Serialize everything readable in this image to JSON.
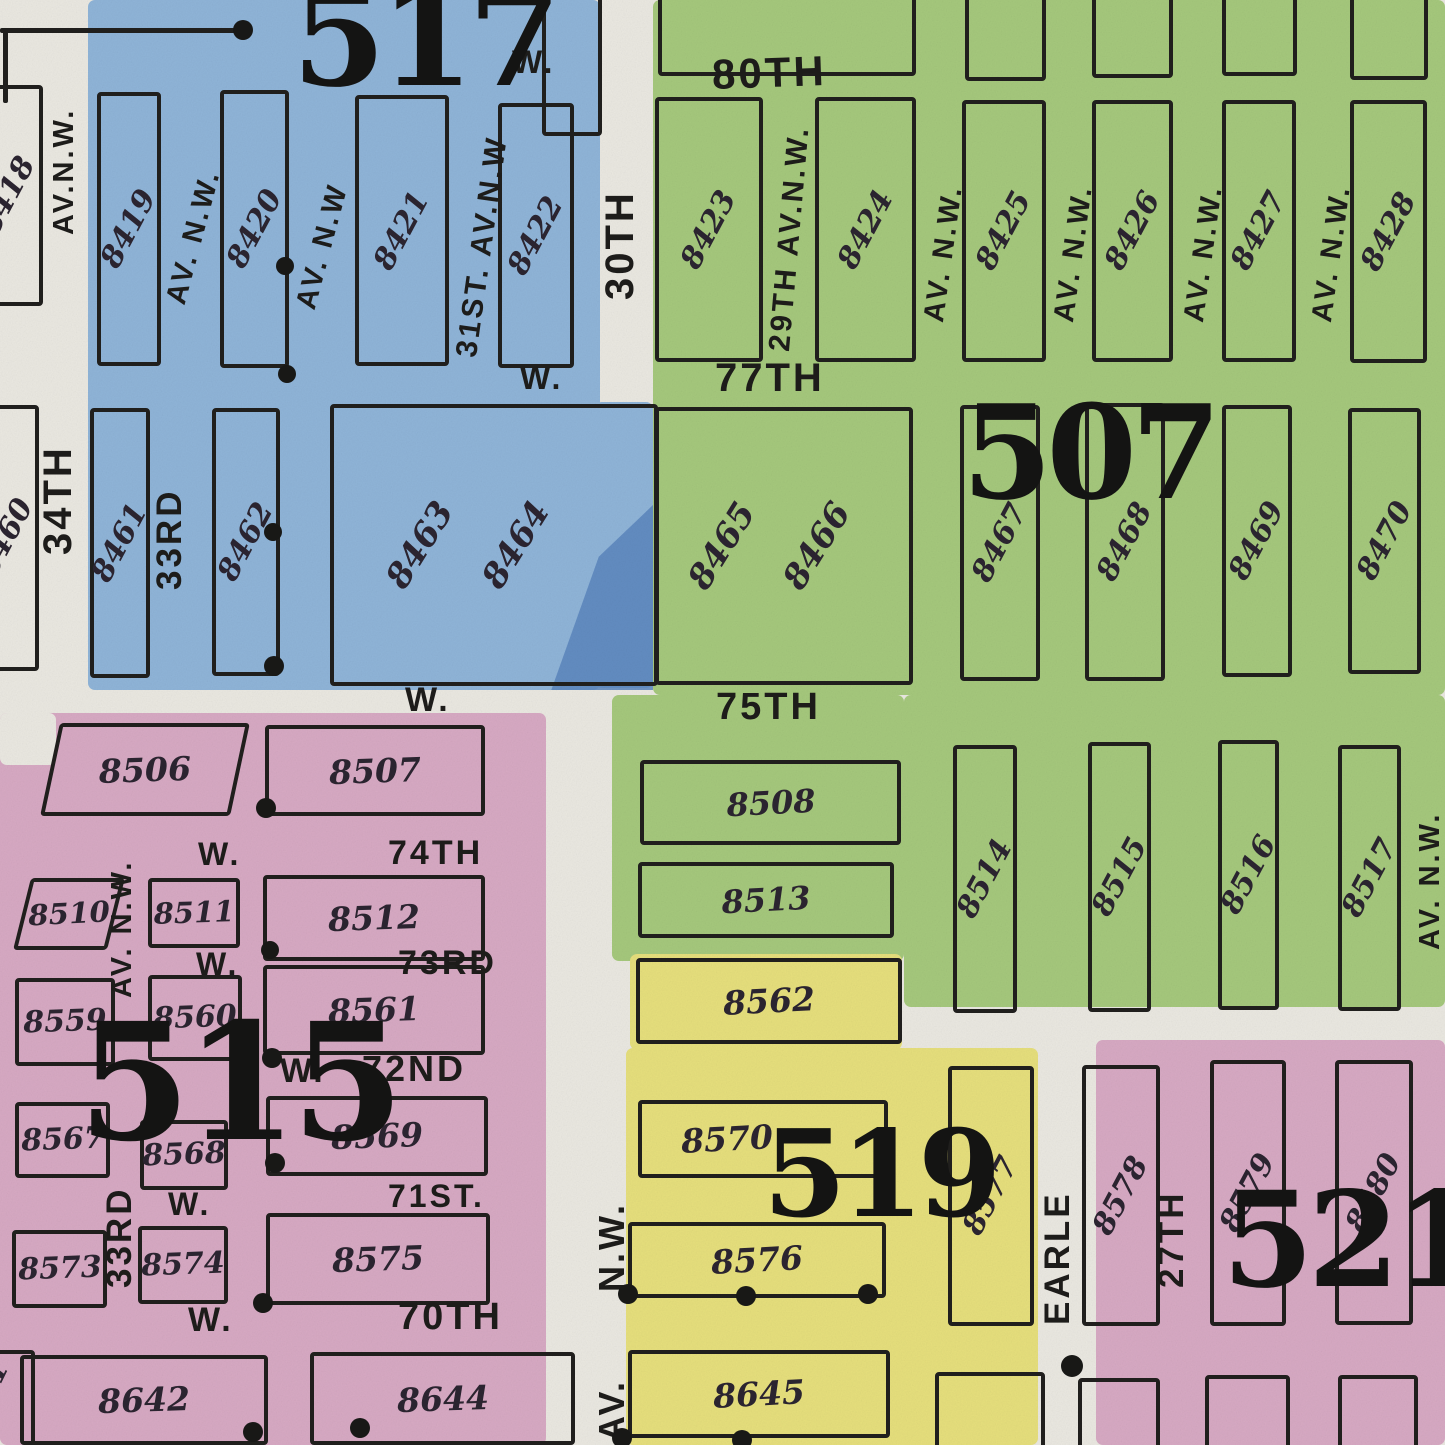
{
  "map_title": "Plat map sheet with insurance districts 507, 515, 517, 519, 521",
  "colors": {
    "paper": "#eae8e1",
    "ink": "#201f1d",
    "blue": "#8fb4d8",
    "blue_dark_streak": "#5a85bd",
    "green": "#a5c87c",
    "pink": "#d7a9c3",
    "yellow": "#e6df7c",
    "number_ink": "#2b2430"
  },
  "districts": [
    {
      "number": "517",
      "color": "blue"
    },
    {
      "number": "507",
      "color": "green"
    },
    {
      "number": "515",
      "color": "pink"
    },
    {
      "number": "519",
      "color": "yellow"
    },
    {
      "number": "521",
      "color": "pink"
    }
  ],
  "washes": [
    {
      "c": "blue",
      "x": 88,
      "y": 0,
      "w": 512,
      "h": 690
    },
    {
      "c": "blue",
      "x": 595,
      "y": 402,
      "w": 58,
      "h": 286
    },
    {
      "c": "green",
      "x": 653,
      "y": 0,
      "w": 792,
      "h": 695
    },
    {
      "c": "green",
      "x": 612,
      "y": 695,
      "w": 292,
      "h": 266
    },
    {
      "c": "green",
      "x": 904,
      "y": 695,
      "w": 541,
      "h": 312
    },
    {
      "c": "pink",
      "x": 0,
      "y": 713,
      "w": 546,
      "h": 732
    },
    {
      "c": "paper",
      "x": 0,
      "y": 713,
      "w": 56,
      "h": 52
    },
    {
      "c": "yellow",
      "x": 630,
      "y": 954,
      "w": 272,
      "h": 96
    },
    {
      "c": "yellow",
      "x": 626,
      "y": 1048,
      "w": 412,
      "h": 397
    },
    {
      "c": "pink",
      "x": 1096,
      "y": 1040,
      "w": 349,
      "h": 405
    }
  ],
  "streak": {
    "x": 540,
    "y": 505,
    "w": 113,
    "h": 185
  },
  "blocks": [
    {
      "n": "8418",
      "x": -28,
      "y": 85,
      "w": 63,
      "h": 213,
      "rot": -62,
      "fs": 30
    },
    {
      "n": "8419",
      "x": 97,
      "y": 92,
      "w": 56,
      "h": 266,
      "rot": -62,
      "fs": 30
    },
    {
      "n": "8420",
      "x": 220,
      "y": 90,
      "w": 61,
      "h": 270,
      "rot": -62,
      "fs": 30
    },
    {
      "n": "8421",
      "x": 355,
      "y": 95,
      "w": 86,
      "h": 263,
      "rot": -62,
      "fs": 30
    },
    {
      "n": "8422",
      "x": 498,
      "y": 103,
      "w": 68,
      "h": 257,
      "rot": -62,
      "fs": 30
    },
    {
      "n": "8460",
      "x": -28,
      "y": 405,
      "w": 59,
      "h": 258,
      "rot": -62,
      "fs": 30
    },
    {
      "n": "8461",
      "x": 90,
      "y": 408,
      "w": 52,
      "h": 262,
      "rot": -62,
      "fs": 30
    },
    {
      "n": "8462",
      "x": 212,
      "y": 408,
      "w": 60,
      "h": 260,
      "rot": -62,
      "fs": 30
    },
    {
      "nums": [
        {
          "t": "8463",
          "lx": 27
        },
        {
          "t": "8464",
          "lx": 57
        }
      ],
      "x": 330,
      "y": 404,
      "w": 320,
      "h": 274,
      "rot": -58,
      "fs": 34
    },
    {
      "n": "8423",
      "x": 655,
      "y": 97,
      "w": 100,
      "h": 257,
      "rot": -62,
      "fs": 30
    },
    {
      "n": "8424",
      "x": 815,
      "y": 97,
      "w": 93,
      "h": 257,
      "rot": -62,
      "fs": 30
    },
    {
      "n": "8425",
      "x": 962,
      "y": 100,
      "w": 76,
      "h": 254,
      "rot": -62,
      "fs": 30
    },
    {
      "n": "8426",
      "x": 1092,
      "y": 100,
      "w": 73,
      "h": 254,
      "rot": -62,
      "fs": 30
    },
    {
      "n": "8427",
      "x": 1222,
      "y": 100,
      "w": 66,
      "h": 254,
      "rot": -62,
      "fs": 30
    },
    {
      "n": "8428",
      "x": 1350,
      "y": 100,
      "w": 69,
      "h": 255,
      "rot": -62,
      "fs": 30
    },
    {
      "nums": [
        {
          "t": "8465",
          "lx": 25
        },
        {
          "t": "8466",
          "lx": 63
        }
      ],
      "x": 655,
      "y": 407,
      "w": 250,
      "h": 270,
      "rot": -58,
      "fs": 34
    },
    {
      "n": "8467",
      "x": 960,
      "y": 405,
      "w": 72,
      "h": 268,
      "rot": -62,
      "fs": 30
    },
    {
      "n": "8468",
      "x": 1085,
      "y": 403,
      "w": 72,
      "h": 270,
      "rot": -62,
      "fs": 30
    },
    {
      "n": "8469",
      "x": 1222,
      "y": 405,
      "w": 62,
      "h": 264,
      "rot": -62,
      "fs": 30
    },
    {
      "n": "8470",
      "x": 1348,
      "y": 408,
      "w": 65,
      "h": 258,
      "rot": -62,
      "fs": 30
    },
    {
      "n": "8508",
      "x": 640,
      "y": 760,
      "w": 253,
      "h": 77,
      "rot": -3,
      "fs": 32
    },
    {
      "n": "8513",
      "x": 638,
      "y": 862,
      "w": 248,
      "h": 68,
      "rot": -3,
      "fs": 32
    },
    {
      "n": "8514",
      "x": 953,
      "y": 745,
      "w": 56,
      "h": 260,
      "rot": -62,
      "fs": 30
    },
    {
      "n": "8515",
      "x": 1088,
      "y": 742,
      "w": 55,
      "h": 262,
      "rot": -62,
      "fs": 30
    },
    {
      "n": "8516",
      "x": 1218,
      "y": 740,
      "w": 53,
      "h": 262,
      "rot": -62,
      "fs": 30
    },
    {
      "n": "8517",
      "x": 1338,
      "y": 745,
      "w": 55,
      "h": 258,
      "rot": -62,
      "fs": 30
    },
    {
      "n": "8506",
      "x": 50,
      "y": 723,
      "w": 182,
      "h": 85,
      "rot": -2,
      "fs": 33,
      "skew": -12
    },
    {
      "n": "8507",
      "x": 265,
      "y": 725,
      "w": 212,
      "h": 83,
      "rot": -2,
      "fs": 33
    },
    {
      "n": "8510",
      "x": 22,
      "y": 878,
      "w": 86,
      "h": 64,
      "rot": -3,
      "fs": 29,
      "skew": -14
    },
    {
      "n": "8511",
      "x": 148,
      "y": 878,
      "w": 84,
      "h": 62,
      "rot": -2,
      "fs": 29
    },
    {
      "n": "8512",
      "x": 263,
      "y": 875,
      "w": 214,
      "h": 78,
      "rot": -2,
      "fs": 33
    },
    {
      "n": "8559",
      "x": 15,
      "y": 978,
      "w": 92,
      "h": 80,
      "rot": -2,
      "fs": 30
    },
    {
      "n": "8560",
      "x": 148,
      "y": 975,
      "w": 86,
      "h": 78,
      "rot": -2,
      "fs": 30
    },
    {
      "n": "8561",
      "x": 263,
      "y": 965,
      "w": 214,
      "h": 82,
      "rot": -2,
      "fs": 33
    },
    {
      "n": "8567",
      "x": 15,
      "y": 1102,
      "w": 87,
      "h": 68,
      "rot": -2,
      "fs": 30
    },
    {
      "n": "8568",
      "x": 140,
      "y": 1120,
      "w": 80,
      "h": 62,
      "rot": -2,
      "fs": 30
    },
    {
      "n": "8569",
      "x": 266,
      "y": 1096,
      "w": 214,
      "h": 72,
      "rot": -2,
      "fs": 33
    },
    {
      "n": "8573",
      "x": 12,
      "y": 1230,
      "w": 87,
      "h": 70,
      "rot": -2,
      "fs": 30
    },
    {
      "n": "8574",
      "x": 138,
      "y": 1226,
      "w": 82,
      "h": 70,
      "rot": -2,
      "fs": 30
    },
    {
      "n": "8575",
      "x": 266,
      "y": 1213,
      "w": 216,
      "h": 84,
      "rot": -2,
      "fs": 33
    },
    {
      "n": "8642",
      "x": 20,
      "y": 1355,
      "w": 240,
      "h": 82,
      "rot": -2,
      "fs": 33
    },
    {
      "n": "8644",
      "x": 310,
      "y": 1352,
      "w": 257,
      "h": 85,
      "rot": -2,
      "fs": 33
    },
    {
      "n": "8641",
      "x": -70,
      "y": 1350,
      "w": 97,
      "h": 92,
      "rot": -64,
      "fs": 30
    },
    {
      "n": "8562",
      "x": 636,
      "y": 958,
      "w": 258,
      "h": 78,
      "rot": -3,
      "fs": 33
    },
    {
      "n": "8570",
      "x": 638,
      "y": 1100,
      "w": 242,
      "h": 70,
      "rot": -3,
      "fs": 33,
      "numlx": 35
    },
    {
      "n": "8576",
      "x": 628,
      "y": 1222,
      "w": 250,
      "h": 68,
      "rot": -3,
      "fs": 33
    },
    {
      "n": "8645",
      "x": 628,
      "y": 1350,
      "w": 254,
      "h": 80,
      "rot": -3,
      "fs": 33
    },
    {
      "n": "8577",
      "x": 948,
      "y": 1066,
      "w": 78,
      "h": 252,
      "rot": -62,
      "fs": 30
    },
    {
      "n": "8578",
      "x": 1082,
      "y": 1065,
      "w": 70,
      "h": 253,
      "rot": -62,
      "fs": 30
    },
    {
      "n": "8579",
      "x": 1210,
      "y": 1060,
      "w": 68,
      "h": 258,
      "rot": -62,
      "fs": 30
    },
    {
      "n": "8580",
      "x": 1335,
      "y": 1060,
      "w": 70,
      "h": 257,
      "rot": -62,
      "fs": 30
    }
  ],
  "partial_boxes": [
    {
      "x": 542,
      "y": -30,
      "w": 52,
      "h": 158
    },
    {
      "x": 658,
      "y": -42,
      "w": 250,
      "h": 110
    },
    {
      "x": 965,
      "y": -42,
      "w": 73,
      "h": 115
    },
    {
      "x": 1092,
      "y": -42,
      "w": 73,
      "h": 112
    },
    {
      "x": 1222,
      "y": -42,
      "w": 67,
      "h": 110
    },
    {
      "x": 1350,
      "y": -42,
      "w": 70,
      "h": 114
    },
    {
      "x": 935,
      "y": 1372,
      "w": 102,
      "h": 90
    },
    {
      "x": 1078,
      "y": 1378,
      "w": 74,
      "h": 80
    },
    {
      "x": 1205,
      "y": 1375,
      "w": 77,
      "h": 83
    },
    {
      "x": 1338,
      "y": 1375,
      "w": 72,
      "h": 83
    }
  ],
  "street_labels": [
    {
      "t": "80TH",
      "x": 712,
      "y": 52,
      "rot": -2,
      "fs": 42
    },
    {
      "t": "77TH",
      "x": 715,
      "y": 358,
      "rot": 0,
      "fs": 40
    },
    {
      "t": "75TH",
      "x": 716,
      "y": 688,
      "rot": 0,
      "fs": 38
    },
    {
      "t": "W.",
      "x": 512,
      "y": 46,
      "rot": 0,
      "fs": 32
    },
    {
      "t": "W.",
      "x": 520,
      "y": 362,
      "rot": 0,
      "fs": 32
    },
    {
      "t": "W.",
      "x": 405,
      "y": 683,
      "rot": 0,
      "fs": 34
    },
    {
      "t": "W.",
      "x": 198,
      "y": 838,
      "rot": 0,
      "fs": 32
    },
    {
      "t": "74TH",
      "x": 388,
      "y": 836,
      "rot": 0,
      "fs": 34
    },
    {
      "t": "W.",
      "x": 196,
      "y": 948,
      "rot": 0,
      "fs": 32
    },
    {
      "t": "73RD",
      "x": 398,
      "y": 946,
      "rot": 0,
      "fs": 34
    },
    {
      "t": "W.",
      "x": 280,
      "y": 1054,
      "rot": 0,
      "fs": 34
    },
    {
      "t": "72ND",
      "x": 362,
      "y": 1051,
      "rot": 0,
      "fs": 36
    },
    {
      "t": "W.",
      "x": 168,
      "y": 1188,
      "rot": 0,
      "fs": 32
    },
    {
      "t": "71ST.",
      "x": 388,
      "y": 1180,
      "rot": 0,
      "fs": 32
    },
    {
      "t": "W.",
      "x": 188,
      "y": 1303,
      "rot": 0,
      "fs": 34
    },
    {
      "t": "70TH",
      "x": 398,
      "y": 1298,
      "rot": 0,
      "fs": 38
    },
    {
      "t": "30TH",
      "x": 600,
      "y": 300,
      "rot": -90,
      "fs": 40
    },
    {
      "t": "34TH",
      "x": 38,
      "y": 555,
      "rot": -90,
      "fs": 40
    },
    {
      "t": "AV.N.W.",
      "x": 50,
      "y": 235,
      "rot": -90,
      "fs": 29
    },
    {
      "t": "AV. N.W.",
      "x": 162,
      "y": 300,
      "rot": -75,
      "fs": 29
    },
    {
      "t": "AV. N.W",
      "x": 292,
      "y": 305,
      "rot": -75,
      "fs": 29
    },
    {
      "t": "31ST. AV.N.W",
      "x": 452,
      "y": 355,
      "rot": -82,
      "fs": 30
    },
    {
      "t": "33RD",
      "x": 152,
      "y": 590,
      "rot": -90,
      "fs": 35
    },
    {
      "t": "29TH AV.N.W.",
      "x": 765,
      "y": 350,
      "rot": -85,
      "fs": 30
    },
    {
      "t": "AV. N.W.",
      "x": 920,
      "y": 320,
      "rot": -82,
      "fs": 29
    },
    {
      "t": "AV. N.W.",
      "x": 1050,
      "y": 320,
      "rot": -82,
      "fs": 29
    },
    {
      "t": "AV. N.W.",
      "x": 1180,
      "y": 320,
      "rot": -82,
      "fs": 29
    },
    {
      "t": "AV. N.W.",
      "x": 1308,
      "y": 320,
      "rot": -82,
      "fs": 29
    },
    {
      "t": "AV. N.W.",
      "x": 1416,
      "y": 950,
      "rot": -90,
      "fs": 29
    },
    {
      "t": "AV. N.W.",
      "x": 108,
      "y": 998,
      "rot": -90,
      "fs": 29
    },
    {
      "t": "33RD",
      "x": 102,
      "y": 1288,
      "rot": -90,
      "fs": 35
    },
    {
      "t": "N.W.",
      "x": 594,
      "y": 1292,
      "rot": -90,
      "fs": 36
    },
    {
      "t": "AV.",
      "x": 594,
      "y": 1442,
      "rot": -90,
      "fs": 36
    },
    {
      "t": "EARLE",
      "x": 1040,
      "y": 1325,
      "rot": -90,
      "fs": 35
    },
    {
      "t": "27TH",
      "x": 1154,
      "y": 1288,
      "rot": -90,
      "fs": 35
    }
  ],
  "district_numbers": [
    {
      "t": "517",
      "x": 292,
      "y": -30,
      "fs": 135
    },
    {
      "t": "507",
      "x": 962,
      "y": 388,
      "fs": 130
    },
    {
      "t": "515",
      "x": 78,
      "y": 1002,
      "fs": 162
    },
    {
      "t": "519",
      "x": 763,
      "y": 1115,
      "fs": 120
    },
    {
      "t": "521",
      "x": 1222,
      "y": 1175,
      "fs": 132
    }
  ],
  "lines": [
    {
      "x": 0,
      "y": 28,
      "w": 250,
      "h": 5
    },
    {
      "x": 3,
      "y": 28,
      "w": 5,
      "h": 75
    }
  ],
  "dots": [
    {
      "x": 243,
      "y": 30,
      "r": 10
    },
    {
      "x": 285,
      "y": 266,
      "r": 9
    },
    {
      "x": 287,
      "y": 374,
      "r": 9
    },
    {
      "x": 273,
      "y": 532,
      "r": 9
    },
    {
      "x": 274,
      "y": 666,
      "r": 10
    },
    {
      "x": 266,
      "y": 808,
      "r": 10
    },
    {
      "x": 270,
      "y": 950,
      "r": 9
    },
    {
      "x": 272,
      "y": 1058,
      "r": 10
    },
    {
      "x": 275,
      "y": 1163,
      "r": 10
    },
    {
      "x": 263,
      "y": 1303,
      "r": 10
    },
    {
      "x": 253,
      "y": 1432,
      "r": 10
    },
    {
      "x": 360,
      "y": 1428,
      "r": 10
    },
    {
      "x": 628,
      "y": 1294,
      "r": 10
    },
    {
      "x": 746,
      "y": 1296,
      "r": 10
    },
    {
      "x": 868,
      "y": 1294,
      "r": 10
    },
    {
      "x": 622,
      "y": 1438,
      "r": 10
    },
    {
      "x": 742,
      "y": 1440,
      "r": 10
    },
    {
      "x": 1072,
      "y": 1366,
      "r": 11
    }
  ]
}
